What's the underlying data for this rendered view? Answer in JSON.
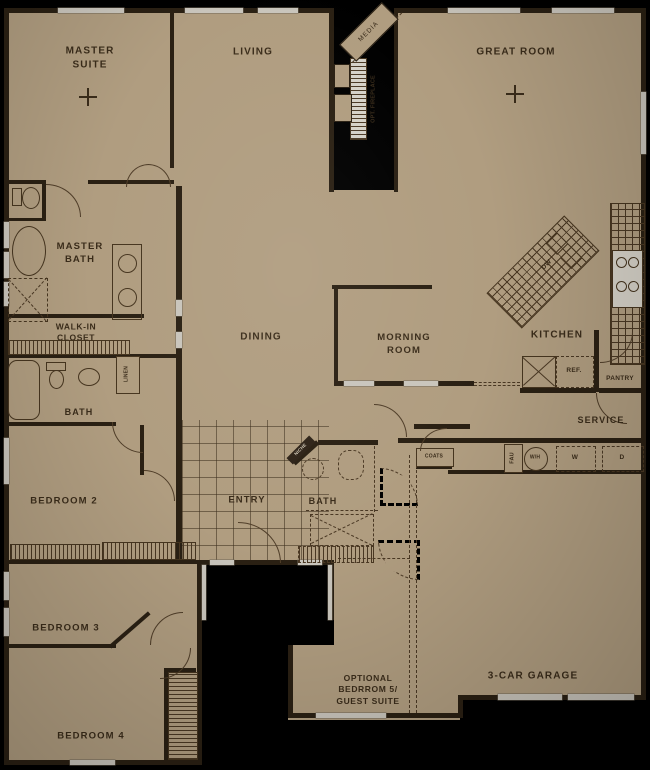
{
  "colors": {
    "background": "#000000",
    "paper": "#b09d80",
    "wall": "#2a2013",
    "text": "#3a2c1a",
    "window": "#c9c5bc"
  },
  "rooms": {
    "master_suite": "MASTER\nSUITE",
    "living": "LIVING",
    "great_room": "GREAT ROOM",
    "master_bath": "MASTER\nBATH",
    "walk_in_closet": "WALK-IN\nCLOSET",
    "bath_hall": "BATH",
    "dining": "DINING",
    "morning_room": "MORNING\nROOM",
    "kitchen": "KITCHEN",
    "service": "SERVICE",
    "bedroom_2": "BEDROOM 2",
    "entry": "ENTRY",
    "bath_center": "BATH",
    "bedroom_3": "BEDROOM 3",
    "optional_bedroom_5": "OPTIONAL\nBEDRROM 5/\nGUEST SUITE",
    "garage": "3-CAR GARAGE",
    "bedroom_4": "BEDROOM 4"
  },
  "fixtures": {
    "media": "MEDIA",
    "opt_fireplace": "OPT. FIREPLACE",
    "linen": "LINEN",
    "niche": "NICHE",
    "coats": "COATS",
    "fau": "FAU",
    "water_heater": "W/H",
    "washer": "W",
    "dryer": "D",
    "refrigerator": "REF.",
    "pantry": "PANTRY",
    "dishwasher": "DW"
  }
}
